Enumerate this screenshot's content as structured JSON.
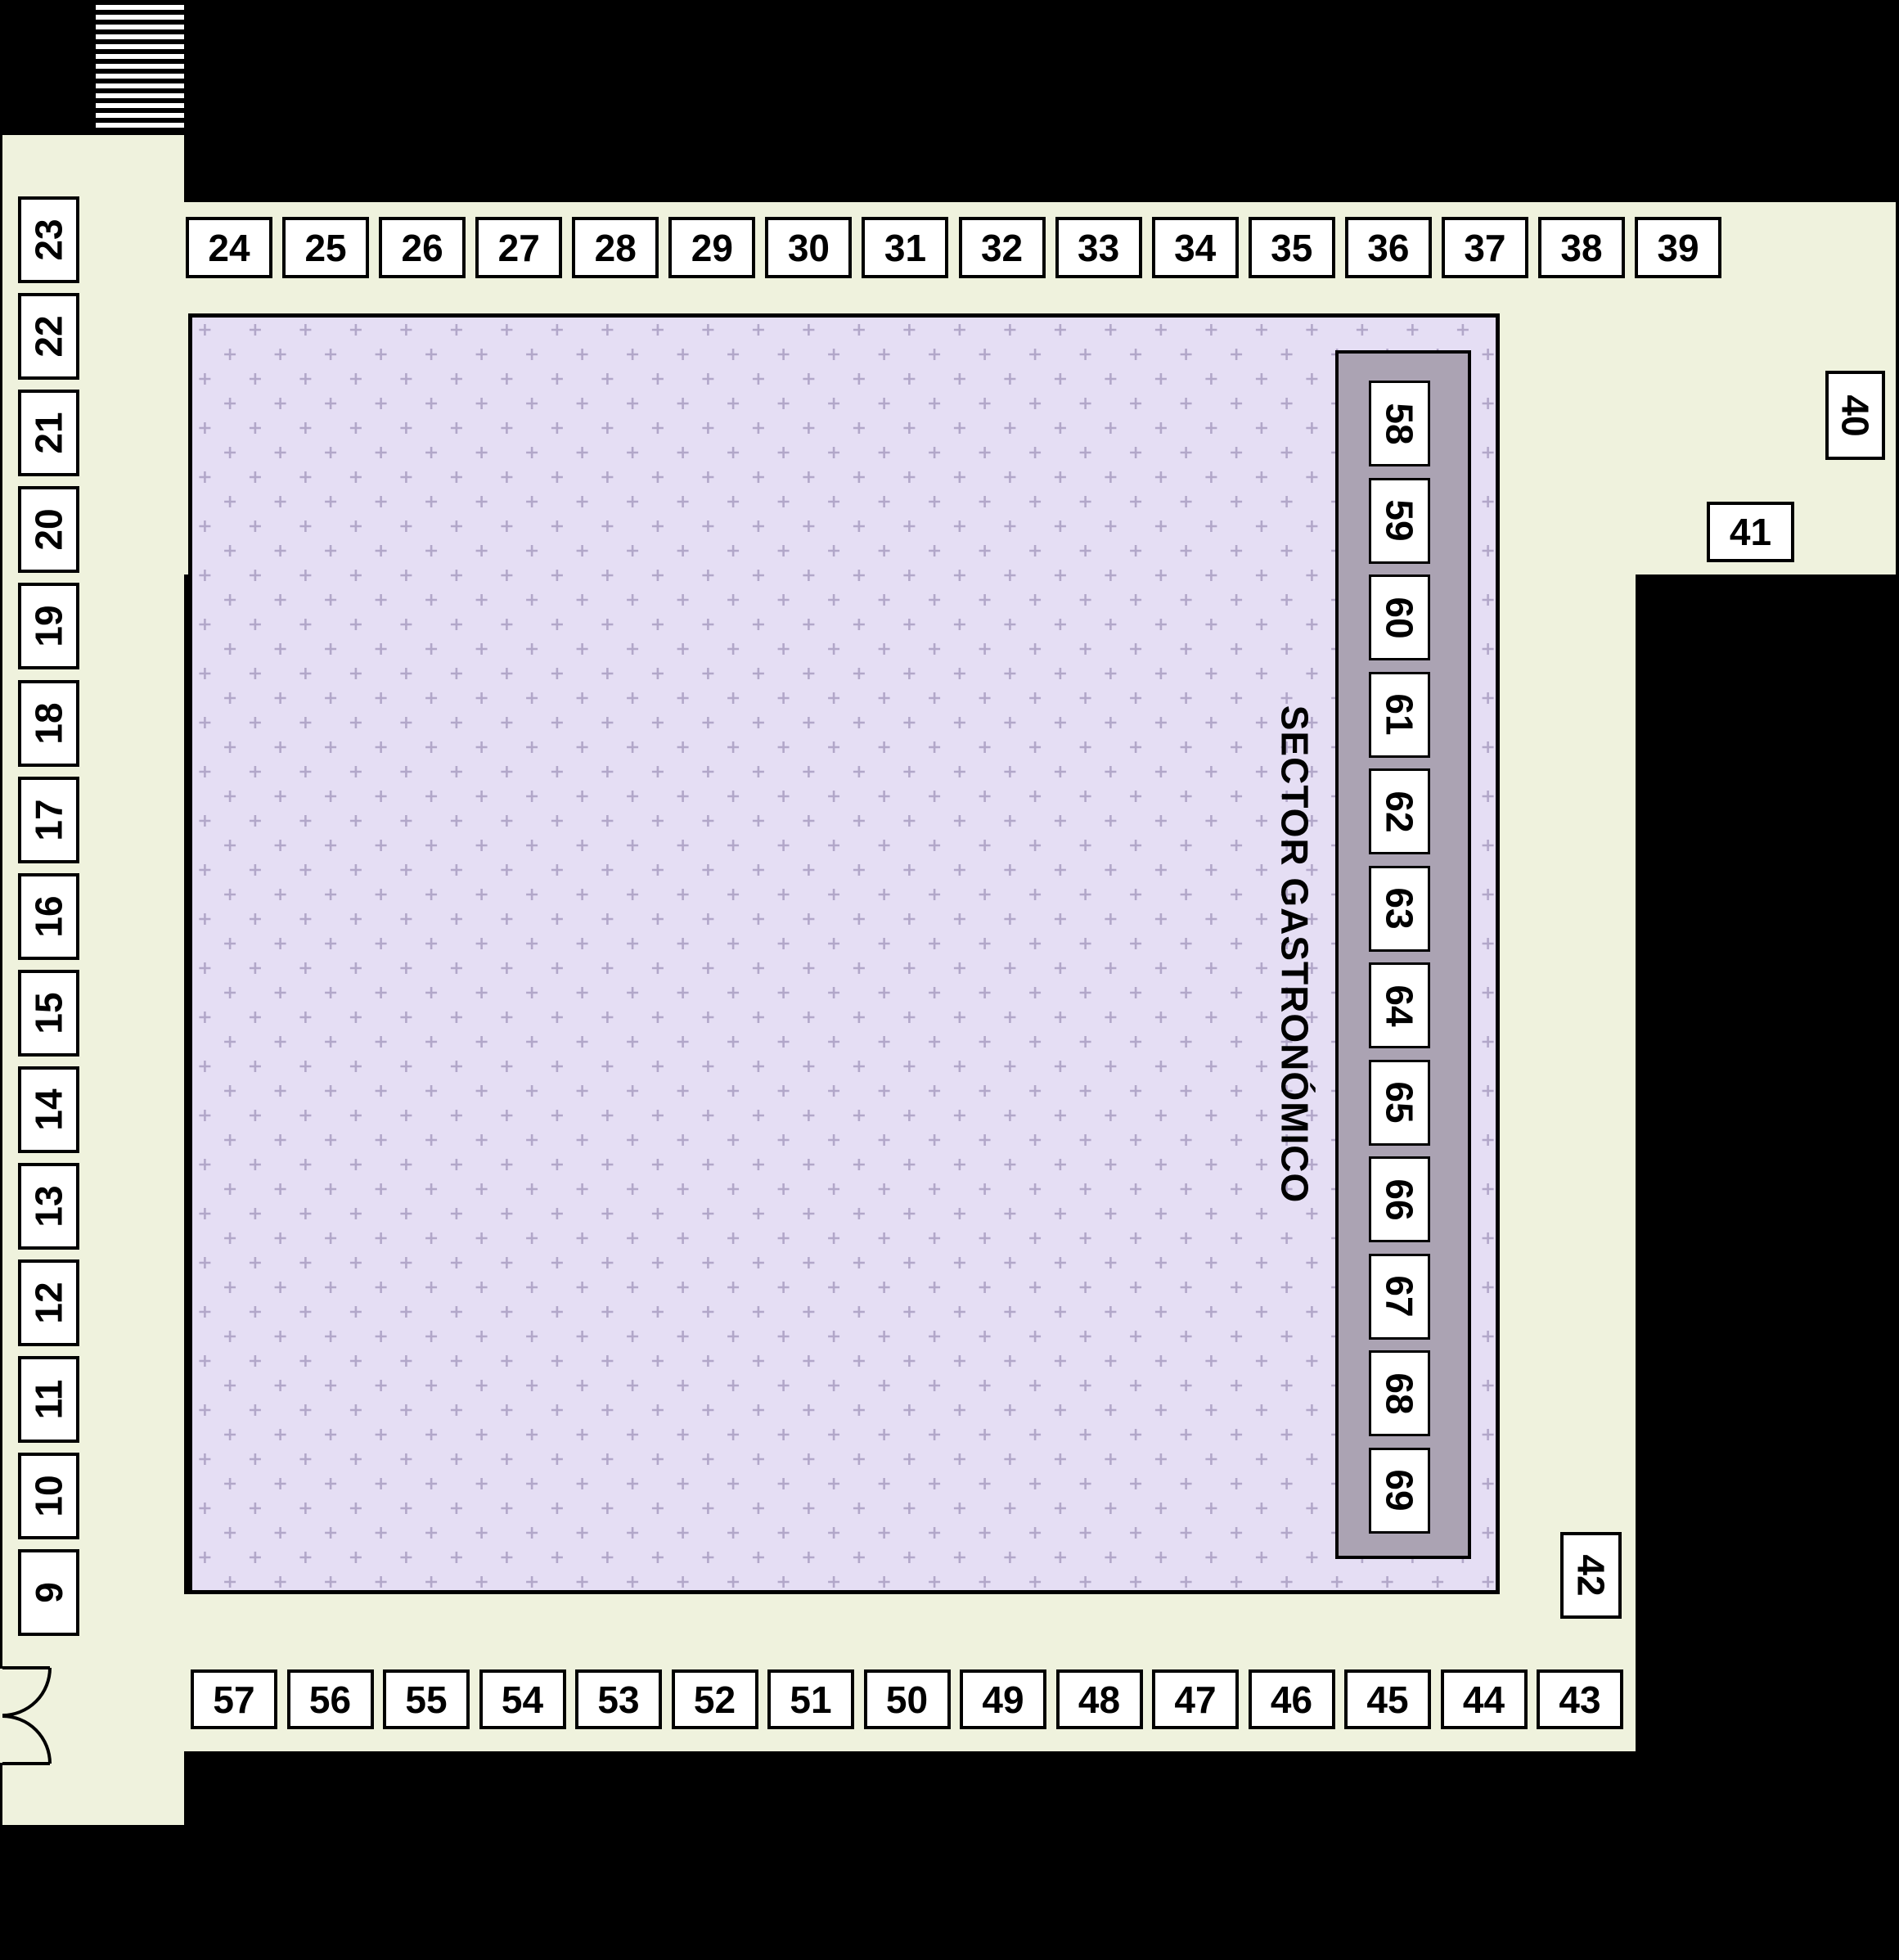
{
  "title": "Feria floor plan",
  "legend": {
    "sector_label": "SECTOR GASTRONÓMICO"
  },
  "stalls": {
    "left_column": [
      "23",
      "22",
      "21",
      "20",
      "19",
      "18",
      "17",
      "16",
      "15",
      "14",
      "13",
      "12",
      "11",
      "10",
      "9"
    ],
    "top_row": [
      "24",
      "25",
      "26",
      "27",
      "28",
      "29",
      "30",
      "31",
      "32",
      "33",
      "34",
      "35",
      "36",
      "37",
      "38",
      "39"
    ],
    "right_side": [
      "40",
      "41",
      "42"
    ],
    "bottom_row": [
      "57",
      "56",
      "55",
      "54",
      "53",
      "52",
      "51",
      "50",
      "49",
      "48",
      "47",
      "46",
      "45",
      "44",
      "43"
    ],
    "inner_strip": [
      "58",
      "59",
      "60",
      "61",
      "62",
      "63",
      "64",
      "65",
      "66",
      "67",
      "68",
      "69"
    ]
  },
  "colors": {
    "background": "#000000",
    "corridor": "#eff2dd",
    "hall": "#e5def4",
    "hall_plus": "#b2a7c9",
    "strip": "#aba3b3",
    "stall_fill": "#ffffff",
    "stall_border": "#000000"
  }
}
